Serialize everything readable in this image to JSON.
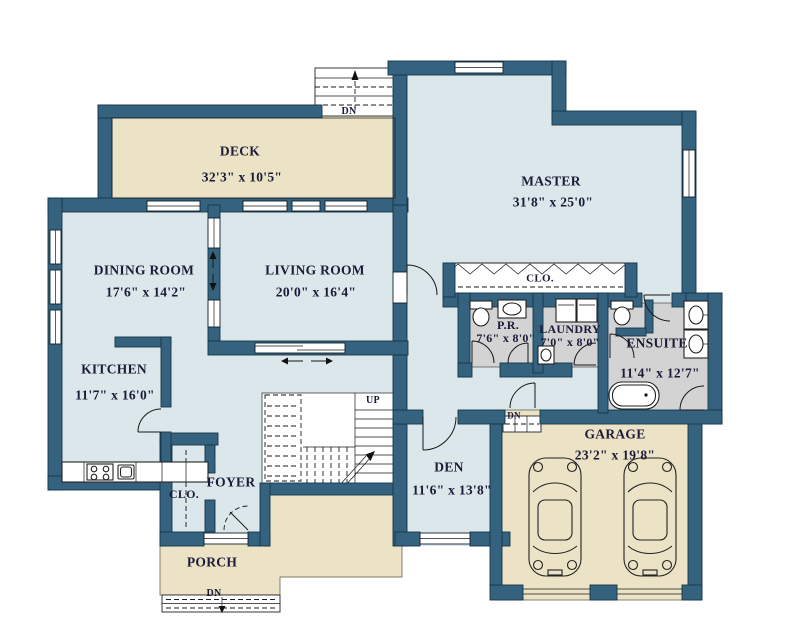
{
  "colors": {
    "wall": "#35627e",
    "room": "#dbe7ea",
    "outdoor": "#ece3c6",
    "bath": "#d3d3d3",
    "background": "#ffffff",
    "text": "#1b1b38"
  },
  "rooms": {
    "deck": {
      "name": "DECK",
      "dims": "32'3\" x 10'5\""
    },
    "master": {
      "name": "MASTER",
      "dims": "31'8\" x 25'0\""
    },
    "dining_room": {
      "name": "DINING ROOM",
      "dims": "17'6\" x 14'2\""
    },
    "living_room": {
      "name": "LIVING ROOM",
      "dims": "20'0\" x 16'4\""
    },
    "kitchen": {
      "name": "KITCHEN",
      "dims": "11'7\" x 16'0\""
    },
    "powder_room": {
      "name": "P.R.",
      "dims": "7'6\" x 8'0\""
    },
    "laundry": {
      "name": "LAUNDRY",
      "dims": "7'0\" x 8'0\""
    },
    "ensuite": {
      "name": "ENSUITE",
      "dims": "11'4\" x 12'7\""
    },
    "den": {
      "name": "DEN",
      "dims": "11'6\" x 13'8\""
    },
    "garage": {
      "name": "GARAGE",
      "dims": "23'2\" x 19'8\""
    },
    "foyer": {
      "name": "FOYER"
    },
    "porch": {
      "name": "PORCH"
    },
    "master_closet": {
      "name": "CLO."
    },
    "foyer_closet": {
      "name": "CLO."
    }
  },
  "stairs": {
    "up": "UP",
    "down": "DN"
  }
}
